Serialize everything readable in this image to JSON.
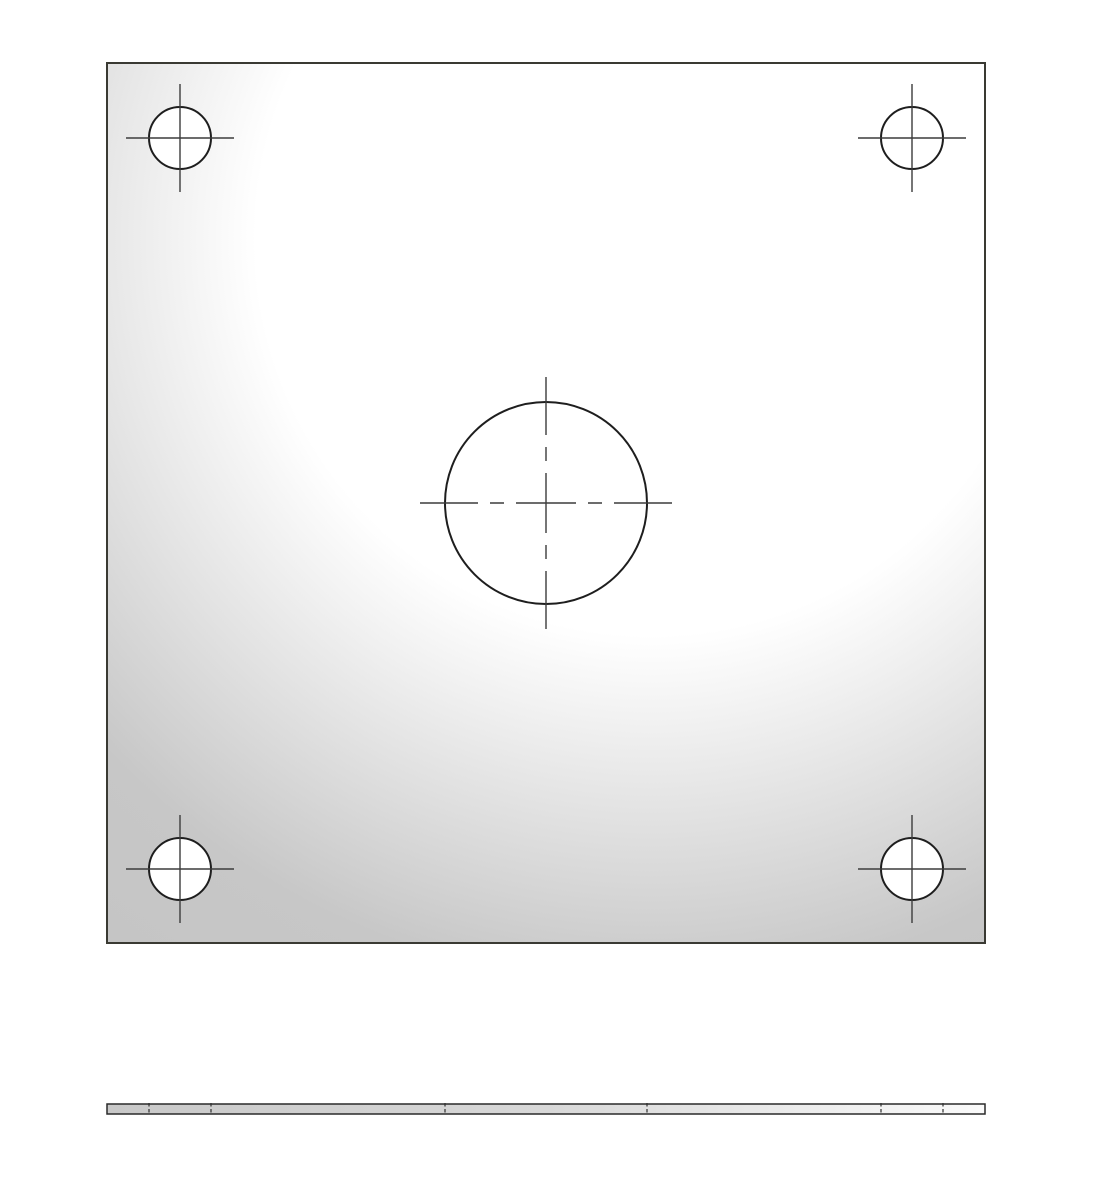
{
  "document": {
    "kind": "engineering-drawing",
    "description": "Square mounting plate: front view with four corner holes and one large center hole, and a thin bottom edge view with hidden hole lines"
  },
  "canvas": {
    "width": 1107,
    "height": 1200,
    "background": "#ffffff"
  },
  "style": {
    "plate_outline_color": "#3a3a33",
    "plate_outline_width": 2,
    "hole_stroke_color": "#1e1e1e",
    "hole_stroke_width": 2,
    "hole_fill": "#ffffff",
    "centerline_color": "#3c3c3c",
    "centerline_width": 1.4,
    "hidden_line_color": "#2f2f2f",
    "hidden_line_width": 1.2,
    "hidden_line_dash": "3.5 2.5",
    "edge_outline_color": "#2a2a2a",
    "edge_outline_width": 1.5,
    "plate_gradient": {
      "cx": "62%",
      "cy": "20%",
      "r": "100%",
      "stops": [
        [
          0,
          "#ffffff"
        ],
        [
          0.45,
          "#ffffff"
        ],
        [
          0.85,
          "#c7c7c7"
        ],
        [
          1,
          "#c5c5c5"
        ]
      ]
    },
    "edge_gradient": {
      "stops": [
        [
          0,
          "#c8c8c8"
        ],
        [
          0.5,
          "#d8d8d8"
        ],
        [
          0.85,
          "#f0f0f0"
        ],
        [
          1,
          "#fafafa"
        ]
      ]
    }
  },
  "front_view": {
    "x": 107,
    "y": 63,
    "width": 878,
    "height": 880,
    "holes": [
      {
        "id": "corner-hole-top-left",
        "cx": 180,
        "cy": 138,
        "r": 31,
        "mark": "solid",
        "mark_extent": 54
      },
      {
        "id": "corner-hole-top-right",
        "cx": 912,
        "cy": 138,
        "r": 31,
        "mark": "solid",
        "mark_extent": 54
      },
      {
        "id": "center-hole",
        "cx": 546,
        "cy": 503,
        "r": 101,
        "mark": "chain",
        "mark_extent": 126,
        "chain_dasharray": "58 12 14 12 60 12 14 12 58"
      },
      {
        "id": "corner-hole-bottom-left",
        "cx": 180,
        "cy": 869,
        "r": 31,
        "mark": "solid",
        "mark_extent": 54
      },
      {
        "id": "corner-hole-bottom-right",
        "cx": 912,
        "cy": 869,
        "r": 31,
        "mark": "solid",
        "mark_extent": 54
      }
    ]
  },
  "side_view": {
    "x": 107,
    "y": 1104,
    "width": 878,
    "height": 10,
    "hidden_lines_x": [
      149,
      211,
      445,
      647,
      881,
      943
    ]
  }
}
